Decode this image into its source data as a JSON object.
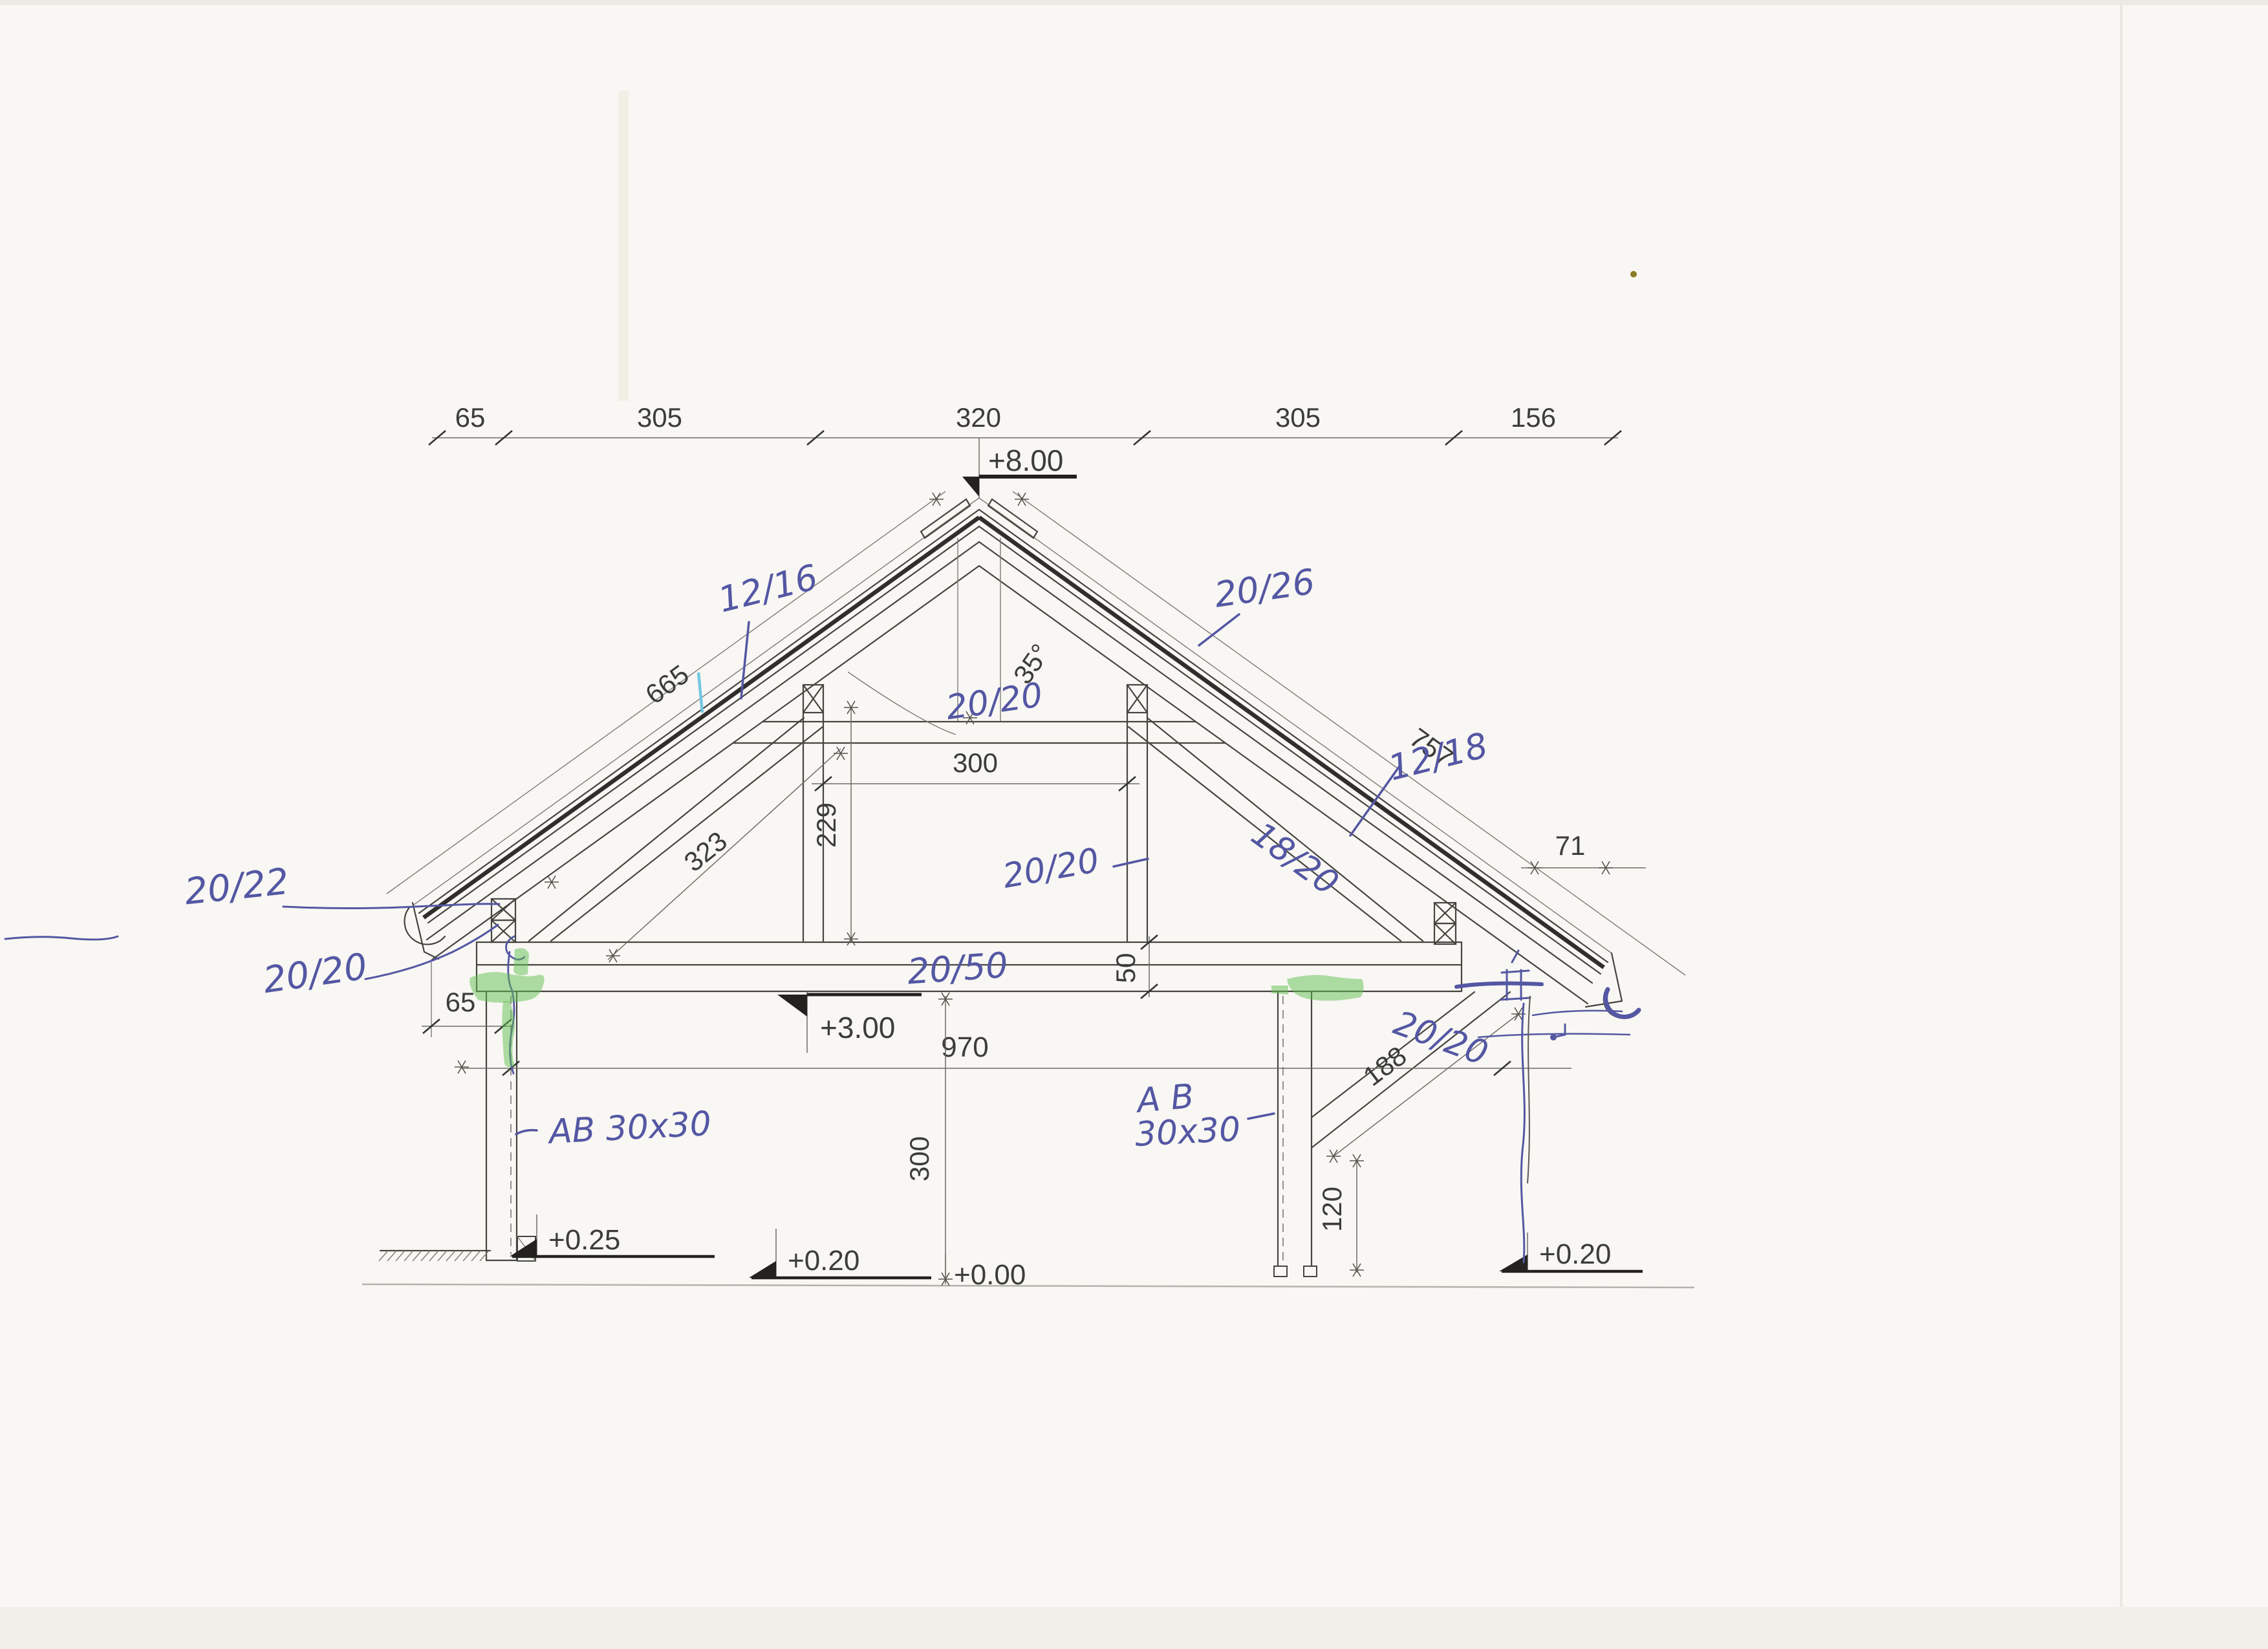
{
  "colors": {
    "paper": "#f8f7f3",
    "pencil": "#45443f",
    "ink_blue": "#5457a3",
    "highlighter_green": "#5fbf4f",
    "cyan_mark": "#74c7e0"
  },
  "top_chain": [
    "65",
    "305",
    "320",
    "305",
    "156"
  ],
  "levels": {
    "ridge": "+8.00",
    "beam": "+3.00",
    "left_base": "+0.25",
    "center_base": "+0.20",
    "zero": "+0.00",
    "right_base": "+0.20"
  },
  "dims": {
    "rafter_left": "665",
    "rafter_right": "757",
    "angle": "35°",
    "collar_span": "300",
    "collar_rise": "229",
    "brace_left": "323",
    "beam_depth": "50",
    "span": "970",
    "overhang_left": "65",
    "overhang_right": "71",
    "knee_length": "188",
    "knee_rise": "120",
    "column_height": "300"
  },
  "hand": {
    "rafter_left": "12/16",
    "purlin_right": "20/26",
    "rafter_right": "12/18",
    "collar": "20/20",
    "purlin_left": "20/22",
    "plate_left": "20/20",
    "beam": "20/50",
    "post": "20/20",
    "brace_right": "18/20",
    "knee": "20/20",
    "anchor_left": "AB 30x30",
    "anchor_right_1": "A B",
    "anchor_right_2": "30x30"
  }
}
